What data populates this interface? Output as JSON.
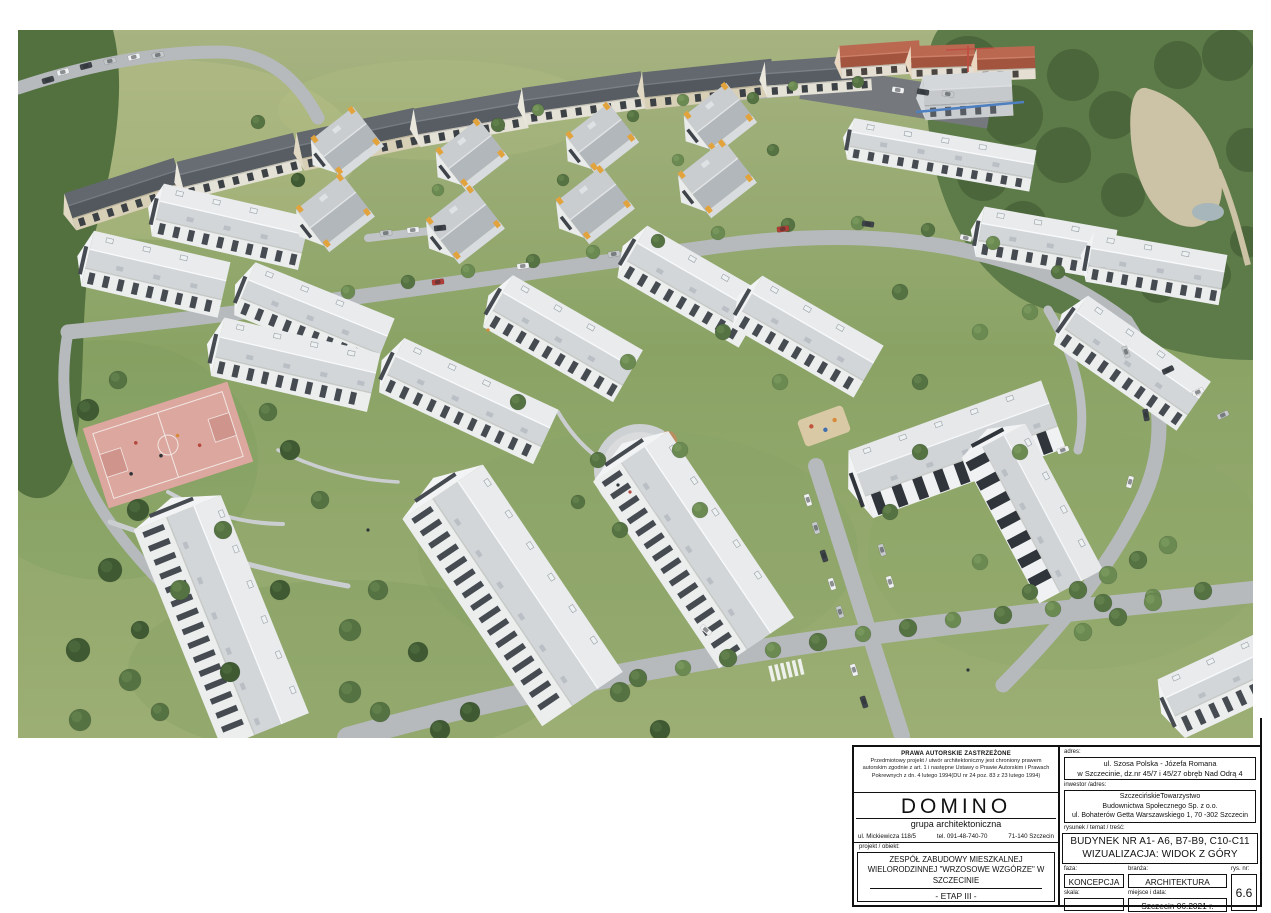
{
  "title_block": {
    "copyright": {
      "title": "PRAWA AUTORSKIE ZASTRZEŻONE",
      "body": "Przedmiotowy projekt / utwór architektoniczny jest chroniony prawem autorskim zgodnie z art. 1 i następne Ustawy o Prawie Autorskim i Prawach Pokrewnych z dn. 4 lutego 1994(DU nr 24 poz. 83 z 23 lutego 1994)"
    },
    "studio": {
      "name": "DOMINO",
      "subtitle": "grupa architektoniczna",
      "street": "ul. Mickiewicza 118/5",
      "phone": "tel. 091-48-740-70",
      "city": "71-140 Szczecin"
    },
    "project": {
      "label": "projekt / obiekt:",
      "name": "ZESPÓŁ ZABUDOWY MIESZKALNEJ WIELORODZINNEJ \"WRZOSOWE WZGÓRZE\" W SZCZECINIE",
      "stage": "- ETAP III -"
    },
    "address": {
      "label": "adres:",
      "line1": "ul. Szosa Polska - Józefa Romana",
      "line2": "w Szczecinie, dz.nr 45/7 i 45/27 obręb Nad Odrą 4"
    },
    "investor": {
      "label": "inwestor /adres:",
      "line1": "SzczecińskieTowarzystwo",
      "line2": "Budownictwa Społecznego Sp. z o.o.",
      "line3": "ul. Bohaterów Getta Warszawskiego 1, 70 -302 Szczecin"
    },
    "drawing": {
      "label": "rysunek / temat / treść:",
      "line1": "BUDYNEK NR A1- A6, B7-B9, C10-C11",
      "line2": "WIZUALIZACJA: WIDOK Z GÓRY"
    },
    "phase": {
      "label": "faza:",
      "value": "KONCEPCJA"
    },
    "branch": {
      "label": "branża:",
      "value": "ARCHITEKTURA"
    },
    "scale": {
      "label": "skala:",
      "value": ""
    },
    "place_date": {
      "label": "miejsce i data:",
      "value": "Szczecin 06.2021 r."
    },
    "drawing_no": {
      "label": "rys. nr:",
      "value": "6.6"
    }
  },
  "colors": {
    "grass": "#8fa468",
    "forest": "#4c6a3c",
    "road": "#b6babd",
    "new_building_wall": "#eceeee",
    "new_building_roof": "#d8dbde",
    "accent_orange": "#e3a33c",
    "existing_roof": "#5a5f65",
    "red_roof": "#b2604e",
    "basketball_court": "#dca79e",
    "window_dark": "#454b51"
  }
}
